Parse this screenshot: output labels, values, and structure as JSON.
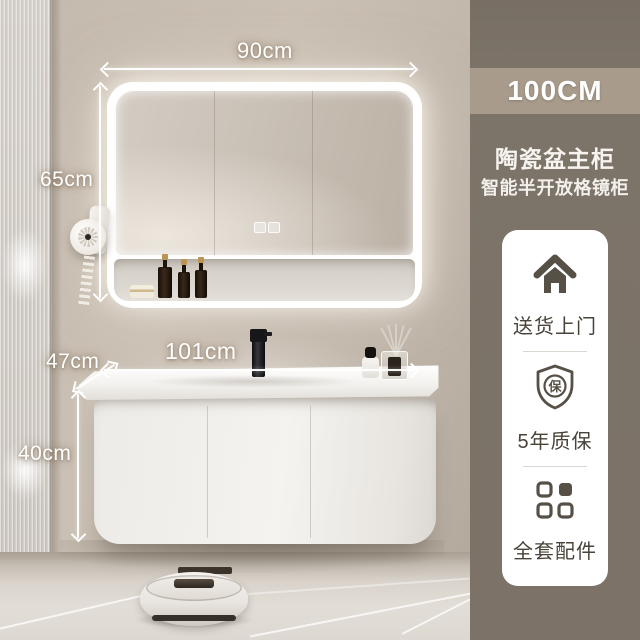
{
  "scene": {
    "dimensions": {
      "mirror_width": "90cm",
      "mirror_height": "65cm",
      "counter_depth": "47cm",
      "counter_width": "101cm",
      "cabinet_height": "40cm"
    }
  },
  "panel": {
    "size_label": "100CM",
    "title": "陶瓷盆主柜",
    "subtitle": "智能半开放格镜柜",
    "features": [
      {
        "icon": "house-icon",
        "label": "送货上门"
      },
      {
        "icon": "shield-icon",
        "label": "5年质保",
        "shield_char": "保"
      },
      {
        "icon": "grid-icon",
        "label": "全套配件"
      }
    ],
    "colors": {
      "panel_bg": "#7c7268",
      "size_band_bg": "#a89b8b",
      "card_bg": "#ffffff",
      "icon_color": "#575047",
      "label_color": "#49433a"
    }
  }
}
